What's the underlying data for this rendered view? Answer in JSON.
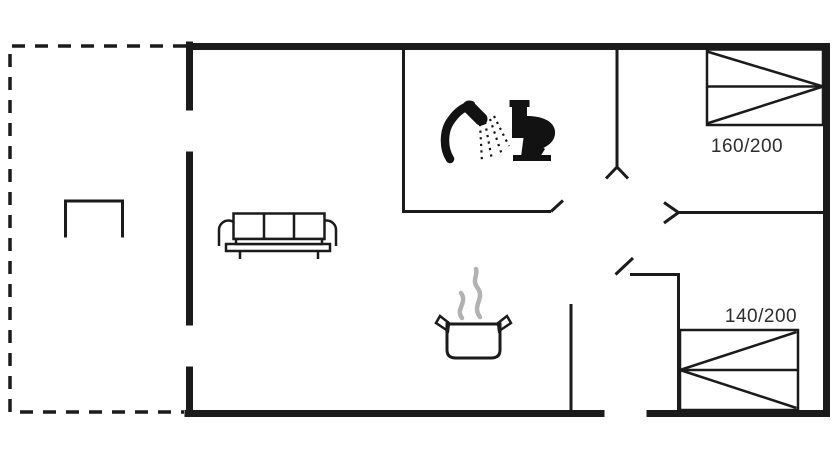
{
  "floorplan": {
    "type": "holiday-house-floor-plan",
    "beds": [
      {
        "id": "double-bed-top-right",
        "label": "160/200"
      },
      {
        "id": "double-bed-bottom-right",
        "label": "140/200"
      }
    ],
    "icons": [
      {
        "name": "shower-icon",
        "shape": "svg-silhouette"
      },
      {
        "name": "toilet-icon",
        "shape": "svg-silhouette"
      },
      {
        "name": "sofa-icon",
        "shape": "svg-outline"
      },
      {
        "name": "cooking-pot-icon",
        "shape": "svg-outline"
      },
      {
        "name": "steam-icon",
        "shape": "svg-curves"
      },
      {
        "name": "terrace-table-icon",
        "shape": "svg-outline"
      },
      {
        "name": "door-swing-icon",
        "shape": "svg-ticks"
      }
    ],
    "colors": {
      "walls": "#1b1b1b",
      "icon_fill": "#121212",
      "steam": "#b2b2b2",
      "label_text": "#2d2d2d",
      "background": "#ffffff"
    }
  }
}
